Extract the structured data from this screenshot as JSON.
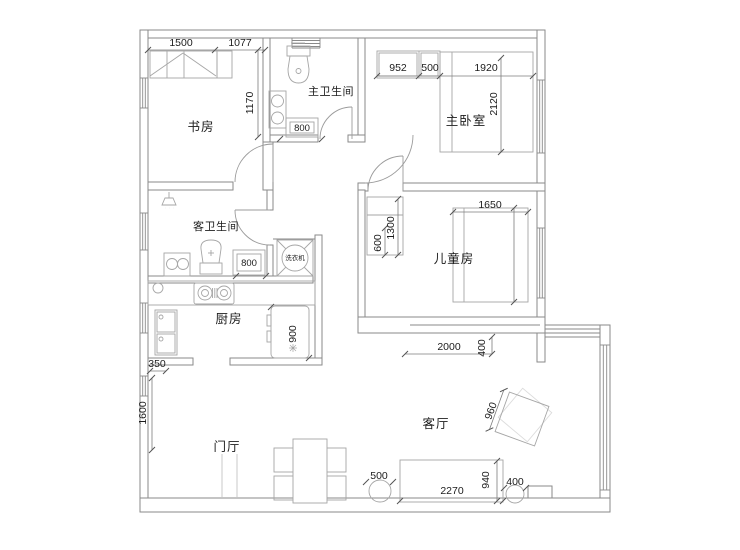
{
  "plan": {
    "rooms": {
      "study": "书房",
      "master_bath": "主卫生间",
      "master_bedroom": "主卧室",
      "guest_bath": "客卫生间",
      "kids_room": "儿童房",
      "kitchen": "厨房",
      "foyer": "门厅",
      "living": "客厅"
    },
    "appliances": {
      "washer": "洗衣机"
    },
    "dims": {
      "d1500": "1500",
      "d1077": "1077",
      "d1170": "1170",
      "d800_master_bath": "800",
      "d952": "952",
      "d500_closet": "500",
      "d1920": "1920",
      "d2120": "2120",
      "d1650": "1650",
      "d1300": "1300",
      "d600": "600",
      "d800_guest_bath": "800",
      "d900_fridge": "900",
      "d350": "350",
      "d1600": "1600",
      "d2000": "2000",
      "d400_wall": "400",
      "d960": "960",
      "d500_stool": "500",
      "d2270": "2270",
      "d940": "940",
      "d400_stool": "400"
    },
    "colors": {
      "wall_line": "#8a8a8a",
      "fixture_line": "#a6a6a6",
      "dim_line": "#7d7d7d",
      "text": "#1c1c1c",
      "background": "#ffffff"
    }
  }
}
